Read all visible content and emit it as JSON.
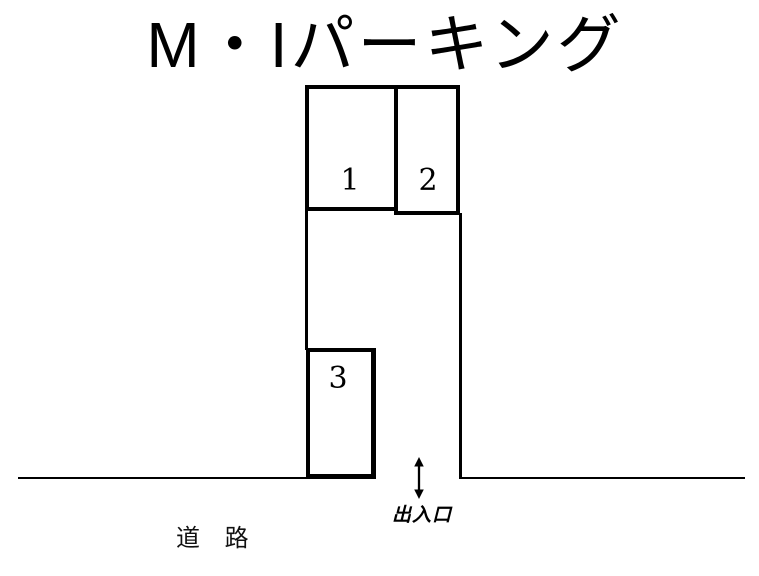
{
  "title": "M・Iパーキング",
  "lot": {
    "spaces": [
      {
        "id": "1",
        "label": "1"
      },
      {
        "id": "2",
        "label": "2"
      },
      {
        "id": "3",
        "label": "3"
      }
    ],
    "entrance": {
      "label": "出入口",
      "arrow_icon": "up-down-arrow"
    },
    "road": {
      "label": "道 路"
    },
    "colors": {
      "line": "#000000",
      "text": "#000000",
      "background": "#ffffff"
    }
  }
}
